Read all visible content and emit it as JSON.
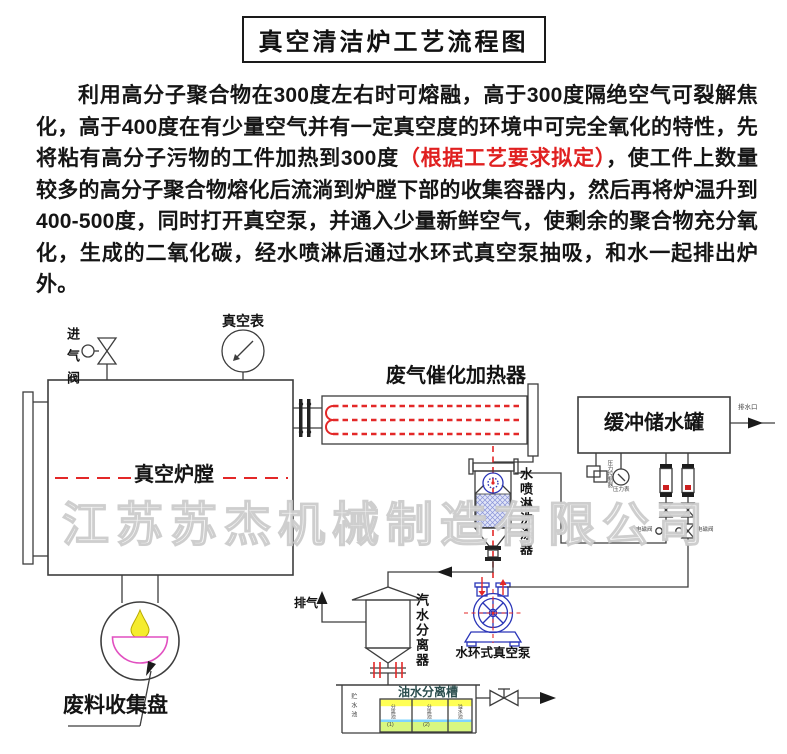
{
  "title": "真空清洁炉工艺流程图",
  "intro": {
    "part1": "利用高分子聚合物在300度左右时可熔融，高于300度隔绝空气可裂解焦化，高于400度在有少量空气并有一定真空度的环境中可完全氧化的特性，先将粘有高分子污物的工件加热到300度",
    "red": "（根据工艺要求拟定）",
    "part2": "，使工件上数量较多的高分子聚合物熔化后流淌到炉膛下部的收集容器内，然后再将炉温升到400-500度，同时打开真空泵，并通入少量新鲜空气，使剩余的聚合物充分氧化，生成的二氧化碳，经水喷淋后通过水环式真空泵抽吸，和水一起排出炉外。"
  },
  "watermark": "江苏苏杰机械制造有限公司",
  "diagram": {
    "labels": {
      "inlet_valve": "进气阀",
      "vacuum_gauge": "真空表",
      "furnace_chamber": "真空炉膛",
      "catalytic_heater": "废气催化加热器",
      "buffer_tank": "缓冲储水罐",
      "tank_outlet": "排水口",
      "spray_washer": "水喷淋洗涤器",
      "steam_water_separator": "汽水分离器",
      "exhaust": "排气",
      "vacuum_pump": "水环式真空泵",
      "waste_tray": "废料收集盘",
      "oil_water_tank": "油水分离槽",
      "pressure_controller": "压力控制器",
      "pressure_gauge": "压力表",
      "valve_left": "电磁阀",
      "valve_right": "电磁阀",
      "pool_storage": "贮水池",
      "pool_sep": "分离池",
      "pool_1": "(1)",
      "pool_2": "(2)",
      "pool_overflow": "溢水池"
    },
    "colors": {
      "centerline_red": "#e32828",
      "coil_red": "#e34040",
      "pump_blue": "#2a35b8",
      "washer_fill_blue": "#8a94d8",
      "drop_yellow": "#f5ec2e",
      "bowl_pink": "#e14fc0",
      "band_yellow": "#ffff55",
      "band_green": "#d8f780",
      "water_cyan": "#7fd4ff",
      "red_text": "#e02020"
    }
  }
}
